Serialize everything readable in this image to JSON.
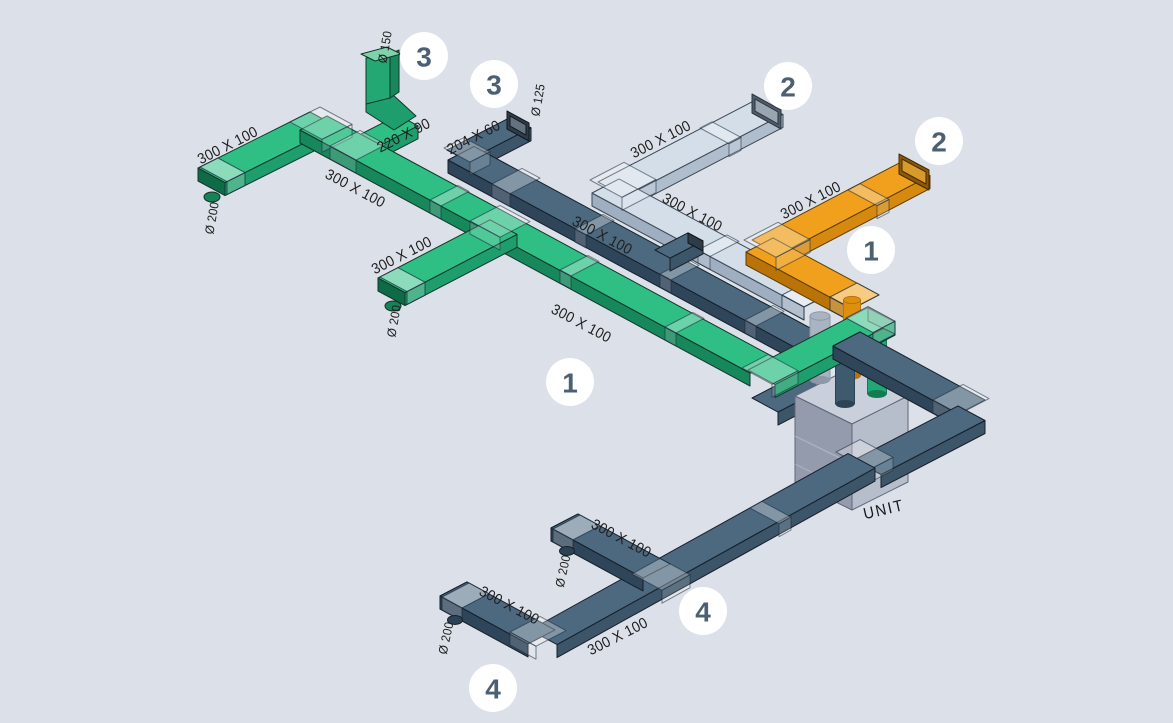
{
  "diagram_title": "Ductwork isometric schematic",
  "unit": {
    "label": "UNIT"
  },
  "colors": {
    "background": "#DCE1E9",
    "green": {
      "top": "#2FBE84",
      "sideA": "#17875C",
      "sideB": "#1E9E6C",
      "stroke": "#143528"
    },
    "slate": {
      "top": "#4C6980",
      "sideA": "#2F4559",
      "sideB": "#3C5569",
      "stroke": "#161F29"
    },
    "lightblue": {
      "top": "#D4DEE9",
      "sideA": "#9FAEC0",
      "sideB": "#AFBDCD",
      "stroke": "#3B4856"
    },
    "orange": {
      "top": "#F0A01D",
      "sideA": "#B97306",
      "sideB": "#D6890F",
      "stroke": "#5D3C05"
    },
    "unit": {
      "top": "#C9CFDB",
      "left": "#939BAD",
      "right": "#B6BDCB",
      "plenum_top": "#E0E4EC",
      "plenum_left": "#C6CCD8",
      "plenum_right": "#D6DBE5",
      "stroke": "#5F6778"
    },
    "pipes": {
      "gray": "#A9B4C2",
      "gray_dark": "#8D98A8",
      "orange": "#DE8F0E",
      "orange_dark": "#B87409",
      "slate": "#3E5A6E",
      "slate_dark": "#2C4356",
      "green": "#1FA875",
      "green_dark": "#157A52"
    },
    "label_text": "#1E1E1E",
    "unit_text": "#14181D",
    "badge_bg": "#FFFFFF",
    "badge_text": "#4B6173"
  },
  "badges": [
    {
      "label": "3",
      "x": 424,
      "y": 56
    },
    {
      "label": "3",
      "x": 494,
      "y": 84
    },
    {
      "label": "2",
      "x": 788,
      "y": 86
    },
    {
      "label": "2",
      "x": 939,
      "y": 141
    },
    {
      "label": "1",
      "x": 871,
      "y": 250
    },
    {
      "label": "1",
      "x": 570,
      "y": 382
    },
    {
      "label": "4",
      "x": 703,
      "y": 611
    },
    {
      "label": "4",
      "x": 493,
      "y": 688
    }
  ],
  "annotations": [
    {
      "text": "Ø 150",
      "x": 385,
      "y": 47,
      "rot": -80,
      "kind": "dia"
    },
    {
      "text": "300 X 100",
      "x": 228,
      "y": 146,
      "rot": -27,
      "kind": "dim"
    },
    {
      "text": "Ø 200",
      "x": 212,
      "y": 218,
      "rot": -80,
      "kind": "dia"
    },
    {
      "text": "220 X 90",
      "x": 404,
      "y": 136,
      "rot": -27,
      "kind": "dim"
    },
    {
      "text": "204 X 60",
      "x": 474,
      "y": 138,
      "rot": -27,
      "kind": "dim"
    },
    {
      "text": "Ø 125",
      "x": 538,
      "y": 100,
      "rot": -80,
      "kind": "dia"
    },
    {
      "text": "300 X 100",
      "x": 355,
      "y": 189,
      "rot": 28,
      "kind": "dim"
    },
    {
      "text": "300 X 100",
      "x": 402,
      "y": 256,
      "rot": -27,
      "kind": "dim"
    },
    {
      "text": "Ø 200",
      "x": 394,
      "y": 321,
      "rot": -80,
      "kind": "dia"
    },
    {
      "text": "300 X 100",
      "x": 602,
      "y": 236,
      "rot": 28,
      "kind": "dim"
    },
    {
      "text": "300 X 100",
      "x": 581,
      "y": 324,
      "rot": 28,
      "kind": "dim"
    },
    {
      "text": "300 X 100",
      "x": 661,
      "y": 140,
      "rot": -27,
      "kind": "dim"
    },
    {
      "text": "300 X 100",
      "x": 692,
      "y": 213,
      "rot": 28,
      "kind": "dim"
    },
    {
      "text": "300 X 100",
      "x": 811,
      "y": 201,
      "rot": -27,
      "kind": "dim"
    },
    {
      "text": "UNIT",
      "x": 884,
      "y": 510,
      "rot": -13,
      "kind": "unit"
    },
    {
      "text": "300 X 100",
      "x": 621,
      "y": 539,
      "rot": 28,
      "kind": "dim"
    },
    {
      "text": "Ø 200",
      "x": 563,
      "y": 571,
      "rot": -78,
      "kind": "dia"
    },
    {
      "text": "300 X 100",
      "x": 509,
      "y": 606,
      "rot": 28,
      "kind": "dim"
    },
    {
      "text": "Ø 200",
      "x": 446,
      "y": 638,
      "rot": -78,
      "kind": "dia"
    },
    {
      "text": "300 X 100",
      "x": 618,
      "y": 637,
      "rot": -27,
      "kind": "dim"
    }
  ]
}
